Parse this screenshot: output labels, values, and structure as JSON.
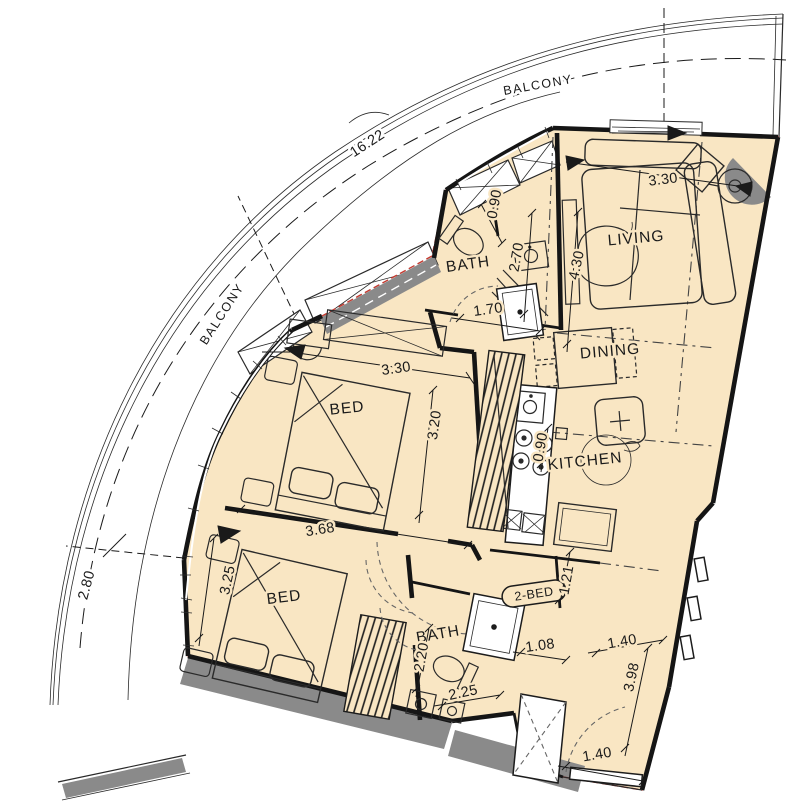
{
  "drawing": {
    "unit_badge": "2-BED",
    "rooms": {
      "balcony_upper": "BALCONY",
      "balcony_lower": "BALCONY",
      "living": "LIVING",
      "dining": "DINING",
      "kitchen": "KITCHEN",
      "bath_upper": "BATH",
      "bath_lower": "BATH",
      "bed_upper": "BED",
      "bed_lower": "BED"
    },
    "dimensions": {
      "balcony_arc_length": "16.22",
      "balcony_width": "2.80",
      "living_width": "3.30",
      "bath_upper_niche": "0.90",
      "bath_upper_length": "2.70",
      "hall_length": "4.30",
      "shower_upper_width": "1.70",
      "bed_upper_width": "3.30",
      "bed_upper_depth": "3.20",
      "bed_lower_width": "3.68",
      "bed_lower_depth": "3.25",
      "kitchen_counter": "0.90",
      "corridor_offset": "1.21",
      "bath_lower_shower": "1.08",
      "bath_lower_depth": "2.20",
      "bath_lower_width": "2.25",
      "corridor_width": "1.40",
      "corridor_length": "3.98",
      "entry_width": "1.40"
    },
    "colors": {
      "floor": "#f9e6c3",
      "wall": "#151515",
      "boundary_red": "#c43b31",
      "structure_gray": "#8a8a8a"
    }
  }
}
